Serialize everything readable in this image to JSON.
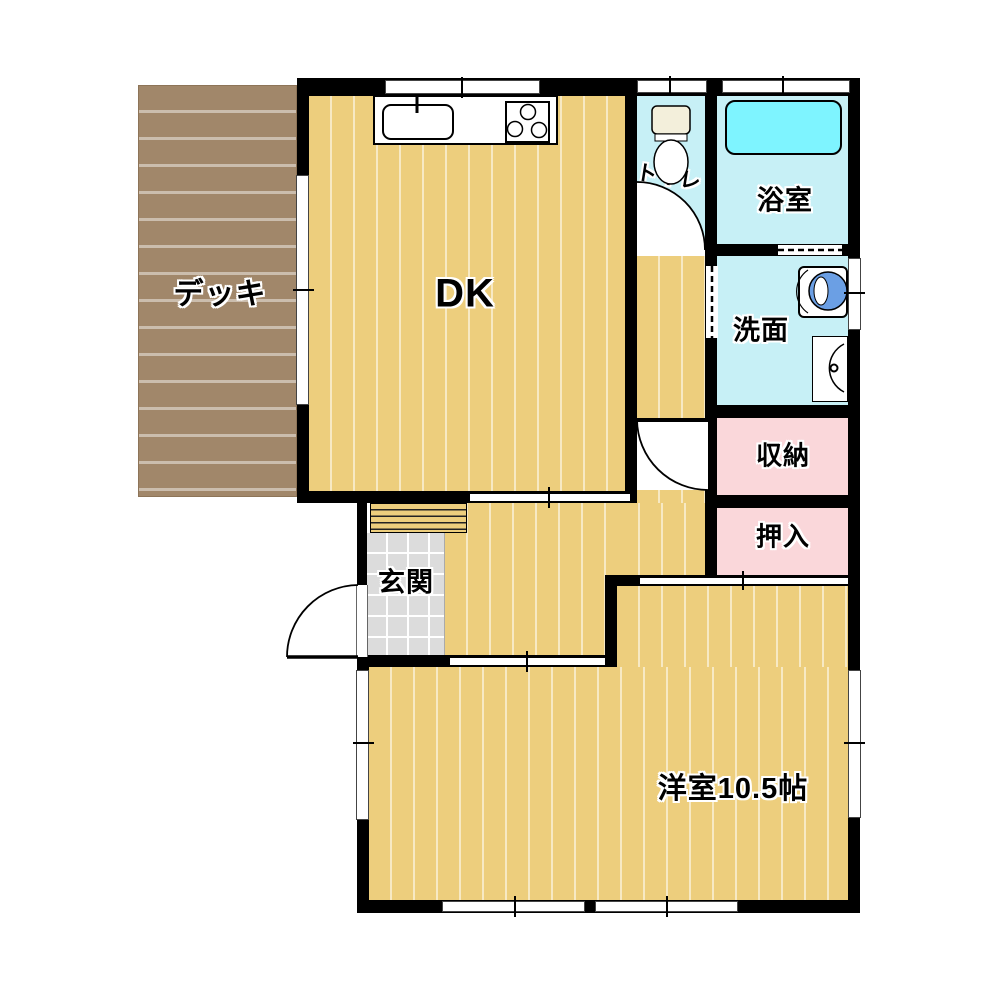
{
  "rooms": {
    "deck": {
      "label": "デッキ"
    },
    "dining_kitchen": {
      "label": "DK"
    },
    "toilet": {
      "label": "トイレ"
    },
    "bathroom": {
      "label": "浴室"
    },
    "washroom": {
      "label": "洗面"
    },
    "storage": {
      "label": "収納"
    },
    "closet": {
      "label": "押入"
    },
    "entrance": {
      "label": "玄関"
    },
    "western_room": {
      "label": "洋室10.5帖"
    }
  },
  "fixtures": {
    "kitchen_sink": "kitchen-sink-icon",
    "stove": "stove-icon",
    "toilet_bowl": "toilet-icon",
    "bathtub": "bathtub-icon",
    "washing_machine": "washing-machine-icon",
    "washbasin": "washbasin-icon"
  },
  "colors": {
    "wall": "#000000",
    "floor_wood": "#EDCE7D",
    "deck_wood": "#A1876A",
    "wet_room": "#C7F0F6",
    "bathtub": "#7EF4FF",
    "storage_pink": "#FAD7DA",
    "entrance_tile": "#DCDCDC",
    "toilet_tank": "#F3EFDB",
    "washer_drum": "#6B9FE4"
  }
}
